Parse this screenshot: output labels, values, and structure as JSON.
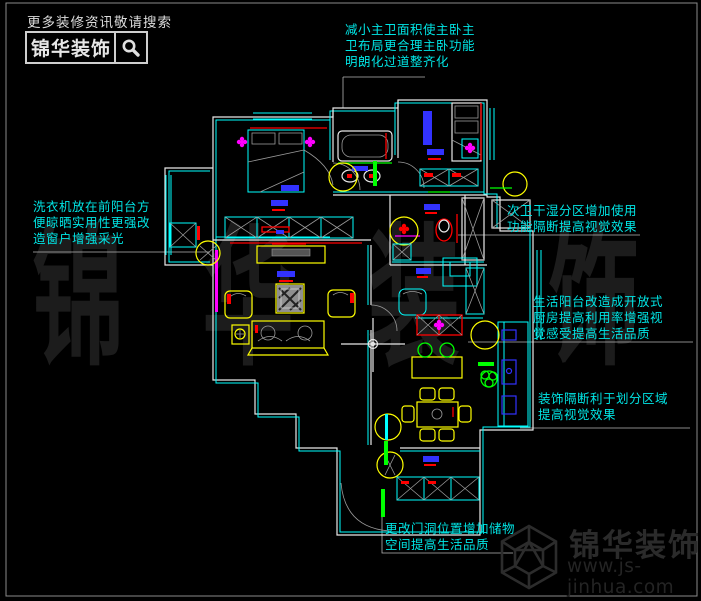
{
  "header": {
    "tagline": "更多装修资讯敬请搜索",
    "brand": "锦华装饰",
    "search_icon": "magnifier-icon"
  },
  "annotations": {
    "master_bath": {
      "lines": [
        "减小主卫面积使主卧主",
        "卫布局更合理主卧功能",
        "明朗化过道整齐化"
      ]
    },
    "washer": {
      "lines": [
        "洗衣机放在前阳台方",
        "便晾晒实用性更强改",
        "造窗户增强采光"
      ]
    },
    "second_bath": {
      "lines": [
        "次卫干湿分区增加使用",
        "功能隔断提高视觉效果"
      ]
    },
    "kitchen": {
      "lines": [
        "生活阳台改造成开放式",
        "厨房提高利用率增强视",
        "觉感受提高生活品质"
      ]
    },
    "partition": {
      "lines": [
        "装饰隔断利于划分区域",
        "提高视觉效果"
      ]
    },
    "entry": {
      "lines": [
        "更改门洞位置增加储物",
        "空间提高生活品质"
      ]
    }
  },
  "watermark": {
    "text": "锦华装饰",
    "chars": [
      "锦",
      "华",
      "装",
      "饰"
    ]
  },
  "footer": {
    "brand": "锦华装饰",
    "url": "www.js-jinhua.com",
    "logo_icon": "cube-logo-icon"
  },
  "colors": {
    "background": "#000000",
    "annotation_cyan": "#00e5e5",
    "wall_outer_white": "#e8e8e8",
    "wall_inner_cyan": "#00ffff",
    "furniture_yellow": "#ffff00",
    "accent_red": "#ff0000",
    "accent_blue": "#3232ff",
    "accent_magenta": "#ff00ff",
    "accent_green": "#00ff00",
    "detail_gray": "#9a9a9a",
    "watermark_gray": "#1c1c1c",
    "logo_gray": "#2b2b2b"
  }
}
